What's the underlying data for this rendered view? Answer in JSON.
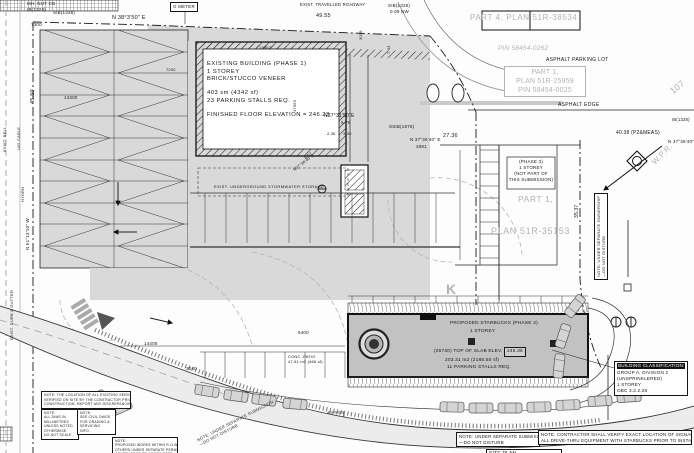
{
  "colors": {
    "paper": "#fdfdfd",
    "asphalt": "#d9d9d9",
    "building_fill": "#c2c2c2",
    "line": "#161616",
    "plan_gray": "#b3b3b3"
  },
  "annotations": [
    {
      "n": "label-mh-nut-cb",
      "t": "MH. NUT CB",
      "x": 27,
      "y": 1,
      "s": 4.5
    },
    {
      "n": "label-ib-1328",
      "t": "IB(1328)",
      "x": 27,
      "y": 7,
      "s": 4.5
    },
    {
      "n": "label-sib-1328",
      "t": "SIB(1328)",
      "x": 53,
      "y": 10,
      "s": 4.5
    },
    {
      "n": "bearing-north-boundary",
      "t": "N 38°3'50\" E",
      "x": 112,
      "y": 15,
      "s": 5.5
    },
    {
      "n": "label-g-meter",
      "t": "G METER",
      "x": 170,
      "y": 2,
      "s": 4.5,
      "bd": 1
    },
    {
      "n": "label-roadway",
      "t": "EXIST. TRAVELLED ROADWAY",
      "x": 300,
      "y": 2,
      "s": 4.2
    },
    {
      "n": "label-sib-1328-b",
      "t": "SIB(1328)",
      "x": 388,
      "y": 3,
      "s": 4.5
    },
    {
      "n": "label-sib-offset",
      "t": "0.09 NW",
      "x": 390,
      "y": 9,
      "s": 4.5
    },
    {
      "n": "dim-49-55",
      "t": "49.55",
      "x": 316,
      "y": 13,
      "s": 5.5
    },
    {
      "n": "dim-7300",
      "t": "7300",
      "x": 31,
      "y": 22,
      "s": 4.5
    },
    {
      "n": "dim-3019",
      "t": "3019",
      "x": 358,
      "y": 40,
      "s": 4,
      "r": -90
    },
    {
      "n": "dim-7-43",
      "t": "7.43",
      "x": 386,
      "y": 54,
      "s": 4,
      "r": -90
    },
    {
      "n": "dim-45-50",
      "t": "45.50",
      "x": 30,
      "y": 104,
      "s": 5.5,
      "r": -90
    },
    {
      "n": "dim-14300",
      "t": "14300",
      "x": 64,
      "y": 95,
      "s": 4.5
    },
    {
      "n": "dim-13867",
      "t": "13867",
      "x": 259,
      "y": 45,
      "s": 4
    },
    {
      "n": "dim-7200",
      "t": "7200",
      "x": 166,
      "y": 67,
      "s": 4
    },
    {
      "n": "dim-17063",
      "t": "17063",
      "x": 292,
      "y": 112,
      "s": 4,
      "r": -90
    },
    {
      "n": "label-part4-plan",
      "t": "PART 4, PLAN 51R-38534",
      "x": 470,
      "y": 13,
      "s": 8,
      "c": "g",
      "ls": 0.6
    },
    {
      "n": "label-pin-58454-0262",
      "t": "PIN 58454-0262",
      "x": 498,
      "y": 45,
      "s": 6.5,
      "c": "g",
      "i": 1
    },
    {
      "n": "label-asphalt-parking-lot",
      "t": "ASPHALT PARKING LOT",
      "x": 546,
      "y": 57,
      "s": 5,
      "ls": 0.3
    },
    {
      "n": "label-part1-plan-25959",
      "x": 504,
      "y": 66,
      "s": 7,
      "c": "g",
      "bd": "g",
      "w": 76,
      "a": "c",
      "lines": [
        "PART 1,",
        "PLAN 51R-25959",
        "PIN 58454-0025"
      ]
    },
    {
      "n": "label-asphalt-edge",
      "t": "ASPHALT EDGE",
      "x": 558,
      "y": 102,
      "s": 5,
      "ls": 0.3
    },
    {
      "n": "label-107",
      "t": "107",
      "x": 668,
      "y": 88,
      "s": 9,
      "c": "g",
      "r": -38
    },
    {
      "n": "label-ib-1328-right",
      "t": "IB(1328)",
      "x": 672,
      "y": 117,
      "s": 4.2
    },
    {
      "n": "dim-40-38",
      "t": "40.38  (P2&MEAS)",
      "x": 616,
      "y": 130,
      "s": 5
    },
    {
      "n": "bearing-north-east",
      "t": "N 37°36'40\" E",
      "x": 668,
      "y": 139,
      "s": 4.5
    },
    {
      "n": "label-wpr",
      "t": "W.P.R.",
      "x": 650,
      "y": 160,
      "s": 8,
      "c": "g",
      "r": -45
    },
    {
      "n": "dim-27-36",
      "t": "27.36",
      "x": 443,
      "y": 133,
      "s": 5.5
    },
    {
      "n": "bearing-mid",
      "t": "N 37°36'40\" E",
      "x": 410,
      "y": 137,
      "s": 4.5
    },
    {
      "n": "dim-3081",
      "t": "3081",
      "x": 416,
      "y": 144,
      "s": 4.5
    },
    {
      "n": "label-ssib-1876",
      "t": "SSIB(1876)",
      "x": 389,
      "y": 124,
      "s": 4.5
    },
    {
      "n": "bearing-3731",
      "t": "N37°31'50\"E",
      "x": 324,
      "y": 113,
      "s": 5
    },
    {
      "n": "dim-5-78",
      "t": "5.78",
      "x": 341,
      "y": 120,
      "s": 4.5
    },
    {
      "n": "dim-2-36",
      "t": "2.36",
      "x": 327,
      "y": 131,
      "s": 4
    },
    {
      "n": "dim-3-39",
      "t": "3.39",
      "x": 343,
      "y": 131,
      "s": 4
    },
    {
      "n": "dim-8-07",
      "t": "8.07",
      "x": 303,
      "y": 156,
      "s": 4,
      "r": -38
    },
    {
      "n": "bearing-diagonal",
      "t": "N37°36'40\"E",
      "x": 292,
      "y": 168,
      "s": 4,
      "r": -38
    },
    {
      "n": "dim-35-37",
      "t": "35.37",
      "x": 574,
      "y": 218,
      "s": 5,
      "r": -90
    },
    {
      "n": "label-stormwater",
      "t": "EXIST. UNDERGROUND STORMWATER STORAGE",
      "x": 214,
      "y": 184,
      "s": 4,
      "ls": 0.4
    },
    {
      "n": "existing-building-label",
      "x": 207,
      "y": 61,
      "s": 5.8,
      "ls": 0.5,
      "lines": [
        "EXISTING BUILDING (PHASE 1)",
        "1 STOREY",
        "BRICK/STUCCO VENEER",
        "",
        "403 sm (4342 sf)",
        "23 PARKING STALLS REQ.",
        "",
        "FINISHED FLOOR ELEVATION = 246.23"
      ]
    },
    {
      "n": "phase3-label",
      "x": 508,
      "y": 159,
      "s": 4.5,
      "a": "c",
      "w": 46,
      "lines": [
        "(PHASE 3)",
        "1 STOREY",
        "(NOT PART OF",
        "THIS SUBMISSION)"
      ]
    },
    {
      "n": "label-part1-mid",
      "t": "PART 1,",
      "x": 518,
      "y": 194,
      "s": 8.5,
      "c": "g",
      "ls": 0.6
    },
    {
      "n": "label-plan-35153",
      "t": "PLAN 51R-35153",
      "x": 491,
      "y": 226,
      "s": 9,
      "c": "g",
      "ls": 0.6
    },
    {
      "n": "note-east-vertical",
      "x": 594,
      "y": 280,
      "s": 4,
      "r": -90,
      "bd": 1,
      "lines": [
        "NOTE: UNDER SEPARATE OWNERSHIP",
        "—DO NOT DISTURB"
      ]
    },
    {
      "n": "label-kiosk",
      "t": "K",
      "x": 446,
      "y": 280,
      "s": 14,
      "c": "g",
      "b": 1
    },
    {
      "n": "starbucks-title",
      "t": "PROPOSED STARBUCKS (PHASE 2)",
      "x": 450,
      "y": 321,
      "s": 4.8,
      "ls": 0.2
    },
    {
      "n": "starbucks-storey",
      "t": "1 STOREY",
      "x": 470,
      "y": 329,
      "s": 4.8
    },
    {
      "n": "starbucks-slab",
      "t": "(25730) TOP OF SLAB ELEV. =",
      "x": 434,
      "y": 349,
      "s": 4.8
    },
    {
      "n": "starbucks-slab-value",
      "t": "246.36",
      "x": 504,
      "y": 347,
      "s": 4.8,
      "bd": 1,
      "bg": "#cfcfcf"
    },
    {
      "n": "starbucks-area",
      "t": "203.31 m2 (2188.50 sf)",
      "x": 445,
      "y": 358,
      "s": 4.8
    },
    {
      "n": "starbucks-stalls",
      "t": "11 PARKING STALLS REQ.",
      "x": 447,
      "y": 365,
      "s": 4.8
    },
    {
      "n": "label-patio",
      "x": 288,
      "y": 354,
      "s": 4,
      "lines": [
        "CONC. PATIO",
        "47.61 m2 (466 sf)"
      ]
    },
    {
      "n": "dim-14400",
      "t": "14400",
      "x": 144,
      "y": 341,
      "s": 4.5
    },
    {
      "n": "dim-3040",
      "t": "3040",
      "x": 186,
      "y": 366,
      "s": 4.5
    },
    {
      "n": "dim-5400",
      "t": "5400",
      "x": 298,
      "y": 330,
      "s": 4.5
    },
    {
      "n": "building-classification",
      "x": 614,
      "y": 361,
      "s": 4.6,
      "bd": 1,
      "w": 68,
      "hdr": "BUILDING CLASSIFICATION:",
      "lines": [
        "GROUP A, DIVISION 2",
        "(UNSPRINKLERED)",
        "1 STOREY",
        "OBC 3.2.2.28"
      ]
    },
    {
      "n": "note-separate-submission",
      "x": 456,
      "y": 432,
      "s": 4.4,
      "bd": 1,
      "w": 78,
      "lines": [
        "NOTE: UNDER SEPARATE SUBMISSION",
        "—DO NOT DISTURB"
      ]
    },
    {
      "n": "note-contractor",
      "x": 538,
      "y": 430,
      "s": 4.4,
      "bd": 1,
      "w": 148,
      "lines": [
        "NOTE: CONTRACTOR SHALL VERIFY EXACT LOCATION OF SIGNAGE AND",
        "ALL DRIVE-THRU EQUIPMENT WITH STARBUCKS PRIOR TO INSTALLATION"
      ]
    },
    {
      "n": "note-diagonal",
      "x": 196,
      "y": 438,
      "s": 4.2,
      "r": -27,
      "c": "d",
      "lines": [
        "NOTE: UNDER SEPARATE SUBMISSION",
        "—DO NOT DISTURB"
      ]
    },
    {
      "n": "note-box-1",
      "x": 41,
      "y": 391,
      "s": 3.5,
      "bd": 1,
      "w": 84,
      "lines": [
        "NOTE: THE LOCATION OF ALL EXISTING SERVICES SHALL BE",
        "VERIFIED ON SITE BY THE CONTRACTOR PRIOR TO",
        "CONSTRUCTION. REPORT ANY DISCREPANCIES."
      ]
    },
    {
      "n": "note-box-2",
      "x": 41,
      "y": 409,
      "s": 3.4,
      "bd": 1,
      "w": 32,
      "lines": [
        "NOTE:",
        "ALL DIMS IN",
        "MILLIMETRES",
        "UNLESS NOTED",
        "OTHERWISE.",
        "DO NOT SCALE."
      ]
    },
    {
      "n": "note-box-3",
      "x": 77,
      "y": 409,
      "s": 3.4,
      "bd": 1,
      "w": 33,
      "lines": [
        "NOTE:",
        "SEE CIVIL DWGS",
        "FOR GRADING &",
        "SERVICING",
        "INFO."
      ]
    },
    {
      "n": "note-box-4",
      "x": 112,
      "y": 437,
      "s": 3.4,
      "bd": 1,
      "w": 60,
      "lines": [
        "NOTE:",
        "PROPOSED WORKS WITHIN R.O.W. BY",
        "OTHERS UNDER SEPARATE PERMIT.",
        "CONTRACTOR TO COORDINATE."
      ]
    },
    {
      "n": "site-plan-title",
      "t": "SITE PLAN",
      "x": 486,
      "y": 449,
      "s": 5,
      "bd": 1,
      "w": 70
    },
    {
      "n": "label-exist-bell",
      "t": "EXIST. BELL",
      "x": 2,
      "y": 152,
      "s": 4,
      "r": -90
    },
    {
      "n": "label-ug-cable",
      "t": "U/G CABLE",
      "x": 16,
      "y": 150,
      "s": 4,
      "r": -90
    },
    {
      "n": "label-hydro",
      "t": "HYDRO",
      "x": 20,
      "y": 202,
      "s": 4,
      "r": -90
    },
    {
      "n": "bearing-west-boundary",
      "t": "N 51°13'10\" W",
      "x": 25,
      "y": 250,
      "s": 4.5,
      "r": -90
    },
    {
      "n": "label-curb-gutter",
      "t": "EXIST. CURB & GUTTER",
      "x": 9,
      "y": 340,
      "s": 4,
      "r": -90
    }
  ]
}
